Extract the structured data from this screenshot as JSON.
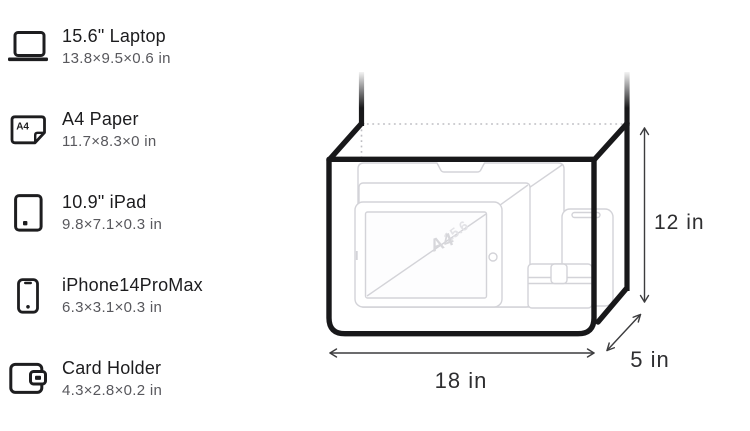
{
  "item_list": {
    "items": [
      {
        "icon": "laptop-icon",
        "title": "15.6\" Laptop",
        "dimensions": "13.8×9.5×0.6 in"
      },
      {
        "icon": "a4-paper-icon",
        "title": "A4 Paper",
        "dimensions": "11.7×8.3×0 in",
        "icon_label": "A4"
      },
      {
        "icon": "tablet-icon",
        "title": "10.9\" iPad",
        "dimensions": "9.8×7.1×0.3 in"
      },
      {
        "icon": "phone-icon",
        "title": "iPhone14ProMax",
        "dimensions": "6.3×3.1×0.3 in"
      },
      {
        "icon": "wallet-icon",
        "title": "Card Holder",
        "dimensions": "4.3×2.8×0.2 in"
      }
    ]
  },
  "diagram": {
    "bag_width_label": "18 in",
    "bag_height_label": "12 in",
    "bag_depth_label": "5 in",
    "watermark_laptop": "15.6",
    "watermark_a4": "A4",
    "colors": {
      "bag_outline": "#18181a",
      "wireframe": "#d3d3d8",
      "dotted_line": "#bdbdc2",
      "dimension_line": "#3c3c3e"
    }
  }
}
